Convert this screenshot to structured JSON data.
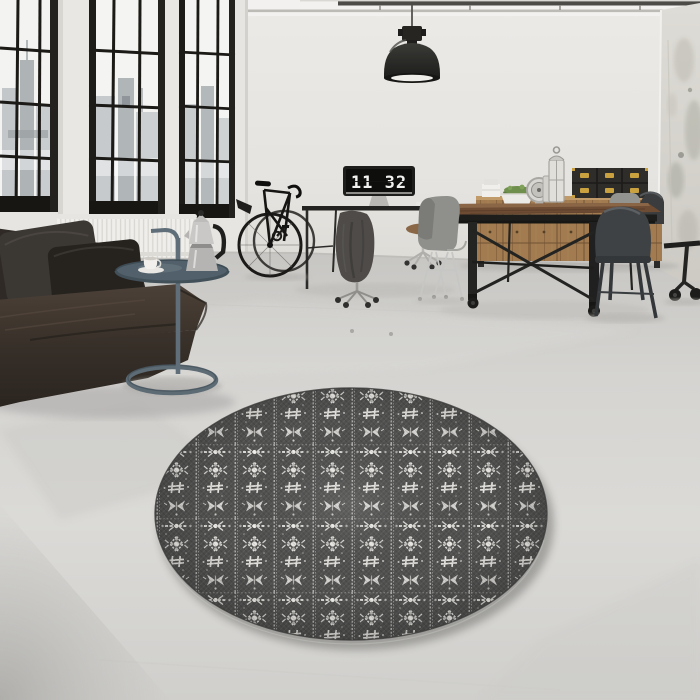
{
  "image": {
    "title": "Round dark gray ornamental rug in an industrial loft living room",
    "type": "interior product photo"
  },
  "clock": {
    "display": "11 32"
  },
  "colors": {
    "wall": "#e8e6e2",
    "ceiling": "#f2f1ef",
    "floor": "#d6d5d2",
    "window_frame": "#1a1916",
    "skyline": "#b8bdc0",
    "sofa_leather": "#3c342c",
    "sofa_pillow": "#2a2724",
    "side_table_metal": "#5d6b75",
    "rug_base": "#515150",
    "rug_pattern": "#e7e6e2",
    "sideboard_wood": "#a07a4e",
    "table_wood": "#6b4a33",
    "metal_chair": "#3f4244",
    "gray_chair": "#90918d",
    "brass_hardware": "#c9a23f",
    "lamp": "#232321"
  },
  "objects": [
    {
      "name": "factory-windows",
      "label": "black-framed factory windows with city view"
    },
    {
      "name": "radiator",
      "label": "white wall radiator"
    },
    {
      "name": "leather-sofa",
      "label": "dark leather sofa with pillows"
    },
    {
      "name": "side-table",
      "label": "round tubular metal side table"
    },
    {
      "name": "moka-pot",
      "label": "stainless moka pot"
    },
    {
      "name": "coffee-cup",
      "label": "white cup and saucer"
    },
    {
      "name": "bicycle",
      "label": "black bicycle leaning on wall"
    },
    {
      "name": "desk-monitor",
      "label": "monitor showing flip clock"
    },
    {
      "name": "office-chairs",
      "label": "office chairs, one with draped jacket"
    },
    {
      "name": "pendant-lamp",
      "label": "black industrial pendant lamp"
    },
    {
      "name": "ceiling-pipes",
      "label": "ceiling conduit pipes"
    },
    {
      "name": "dining-table",
      "label": "industrial wood dining table on casters"
    },
    {
      "name": "shell-chair",
      "label": "gray molded shell chair"
    },
    {
      "name": "tolix-chairs",
      "label": "dark metal cafe chairs"
    },
    {
      "name": "sideboard",
      "label": "wooden multi-drawer sideboard"
    },
    {
      "name": "storage-trunks",
      "label": "black trunks with brass latches"
    },
    {
      "name": "plant-bowl",
      "label": "green plant in white bowl"
    },
    {
      "name": "lanterns",
      "label": "decorative candle lanterns"
    },
    {
      "name": "ornament-clock",
      "label": "round ornate table clock"
    },
    {
      "name": "concrete-column",
      "label": "distressed concrete corner column"
    },
    {
      "name": "rolling-rack",
      "label": "black rolling stand with casters"
    },
    {
      "name": "round-rug",
      "label": "round gray rug with white ornamental pattern"
    }
  ]
}
